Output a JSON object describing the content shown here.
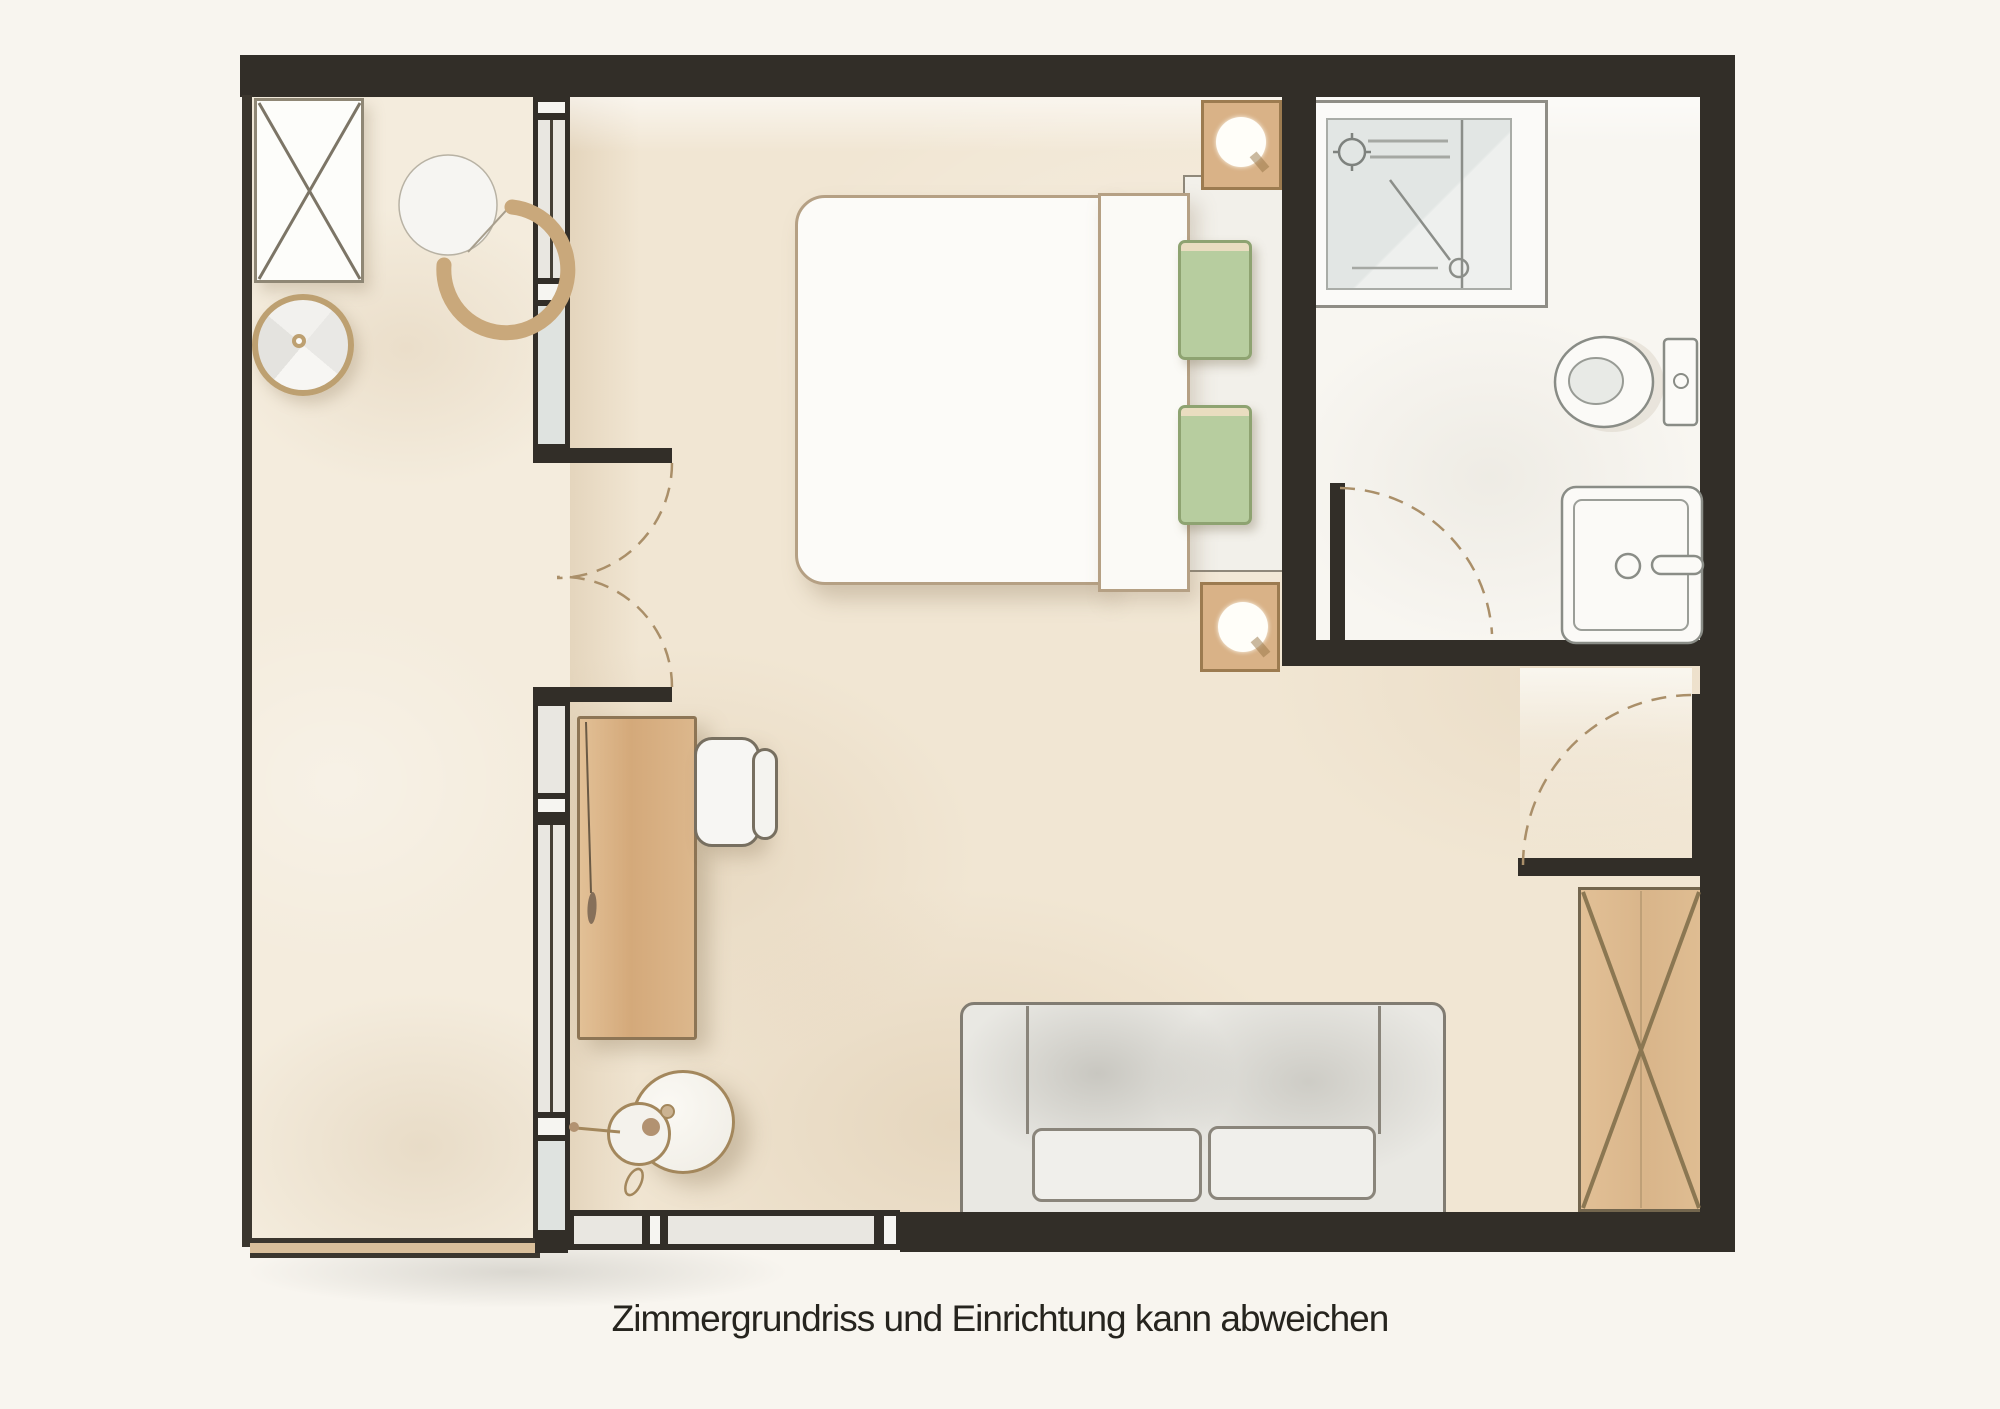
{
  "caption": {
    "text": "Zimmergrundriss und Einrichtung kann abweichen"
  },
  "colors": {
    "paper": "#f8f5ef",
    "wall": "#322e28",
    "wall-soft": "#3b362e",
    "floor-main": "#f1e6d3",
    "floor-left": "#f4ecdd",
    "bath-floor": "#f8f6f1",
    "glass": "#e9e7e1",
    "glass-blue": "#dfe3e0",
    "wood": "#d9b287",
    "wood-dark": "#8d7555",
    "tan": "#c9a87b",
    "white-furn": "#fbfaf7",
    "outline-gray": "#8a8d87",
    "green": "#b7cd9f",
    "green-dark": "#8ea371",
    "door-arc": "#aa8f69",
    "ink": "#26241e"
  },
  "icons": [
    "wardrobe-icon",
    "lounge-chair-icon",
    "side-table-icon",
    "double-bed-icon",
    "pillow-icon",
    "nightstand-lamp-icon",
    "shower-icon",
    "toilet-icon",
    "washbasin-icon",
    "desk-icon",
    "desk-chair-icon",
    "floor-lamp-icon",
    "sofa-icon",
    "door-swing-icon",
    "window-icon"
  ]
}
